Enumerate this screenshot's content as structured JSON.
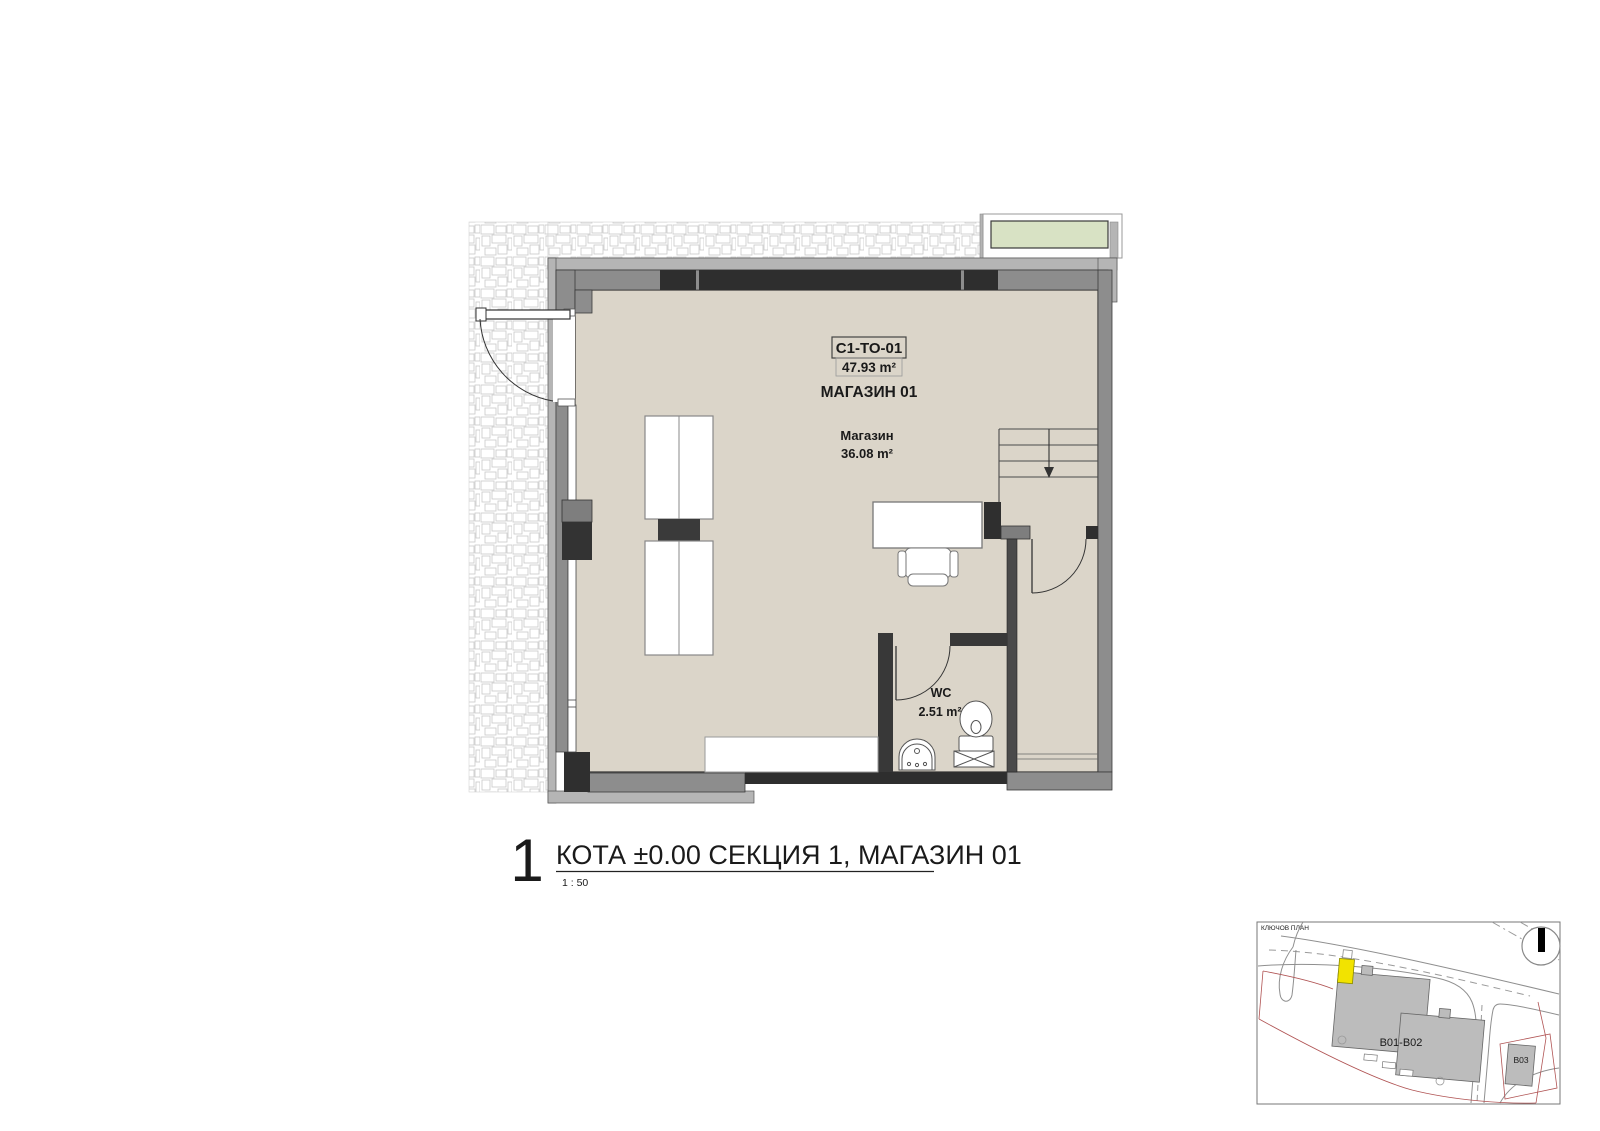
{
  "plan": {
    "unit_code": "C1-TO-01",
    "unit_area": "47.93 m²",
    "unit_name": "МАГАЗИН 01",
    "room_name": "Магазин",
    "room_area": "36.08 m²",
    "wc_name": "WC",
    "wc_area": "2.51 m²"
  },
  "title_block": {
    "number": "1",
    "title": "КОТА ±0.00 СЕКЦИЯ 1, МАГАЗИН 01",
    "scale": "1 : 50"
  },
  "key_plan": {
    "label": "КЛЮЧОВ ПЛАН",
    "building_main": "B01-B02",
    "building_secondary": "B03"
  },
  "colors": {
    "floor": "#dbd5c9",
    "wall": "#8d8d8d",
    "wall_light": "#b5b5b5",
    "wall_dark": "#2e2e2e",
    "planter_green": "#d8e2c4",
    "highlight_yellow": "#f2e300",
    "map_building_gray": "#bcbcbc",
    "parcel_line_red": "#b05353"
  }
}
